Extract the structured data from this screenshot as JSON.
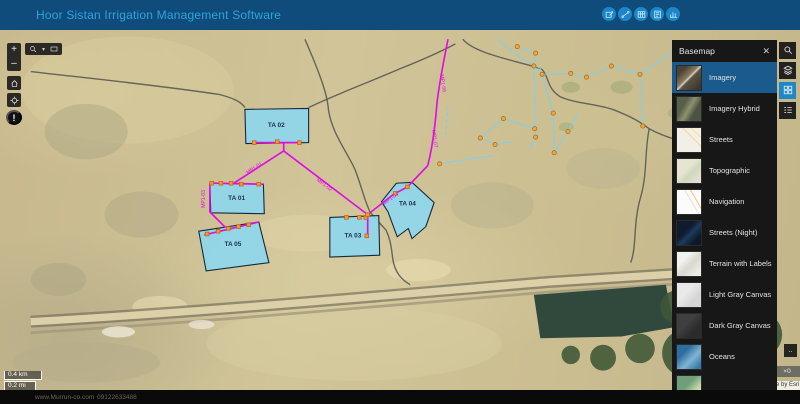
{
  "header": {
    "title": "Hoor Sistan Irrigation Management Software",
    "tools": [
      {
        "name": "edit-tool"
      },
      {
        "name": "measure-tool"
      },
      {
        "name": "table-tool"
      },
      {
        "name": "report-tool"
      },
      {
        "name": "chart-tool"
      }
    ]
  },
  "left_toolbar": {
    "zoom_in": "+",
    "zoom_out": "–",
    "track_glyph": "!"
  },
  "scalebar": {
    "km": "0.4 km",
    "mi": "0.2 mi"
  },
  "basemap_panel": {
    "title": "Basemap",
    "close_glyph": "✕",
    "items": [
      {
        "label": "Imagery",
        "thumb": "imagery",
        "selected": true
      },
      {
        "label": "Imagery Hybrid",
        "thumb": "hybrid",
        "selected": false
      },
      {
        "label": "Streets",
        "thumb": "streets",
        "selected": false
      },
      {
        "label": "Topographic",
        "thumb": "topo",
        "selected": false
      },
      {
        "label": "Navigation",
        "thumb": "nav",
        "selected": false
      },
      {
        "label": "Streets (Night)",
        "thumb": "night",
        "selected": false
      },
      {
        "label": "Terrain with Labels",
        "thumb": "terrain",
        "selected": false
      },
      {
        "label": "Light Gray Canvas",
        "thumb": "lightgray",
        "selected": false
      },
      {
        "label": "Dark Gray Canvas",
        "thumb": "darkgray",
        "selected": false
      },
      {
        "label": "Oceans",
        "thumb": "oceans",
        "selected": false
      },
      {
        "label": "",
        "thumb": "natgeo",
        "selected": false
      }
    ]
  },
  "attribution": {
    "partial": "e by Esri",
    "badge": "×0",
    "expand_glyph": ".."
  },
  "footer": {
    "website": "www.Murrun-co.com",
    "phone": "09122633488"
  },
  "map_features": {
    "colors": {
      "pipe": "#e10ee1",
      "channel": "#7dcff0",
      "zone_fill": "#8ed7ec",
      "zone_stroke": "#16293c",
      "marker": "#f49b2d",
      "marker_stroke": "#c45f12",
      "boundary": "#52524c",
      "node": "#f2a43e",
      "node_stroke": "#a86a1a",
      "zone_label": "#1d2f52"
    },
    "zones": [
      {
        "label": "TA 02",
        "points": "232,116 301,115 301,152 233,153",
        "lx": 266,
        "ly": 135
      },
      {
        "label": "TA 01",
        "points": "194,196 252,197 253,229 195,228",
        "lx": 223,
        "ly": 214
      },
      {
        "label": "TA 05",
        "points": "182,248 247,238 258,282 190,291",
        "lx": 219,
        "ly": 264
      },
      {
        "label": "TA 03",
        "points": "324,233 377,231 378,274 324,276",
        "lx": 349,
        "ly": 255
      },
      {
        "label": "TA 04",
        "points": "380,216 396,196 413,195 437,217 428,243 413,256 409,245 397,254 387,227",
        "lx": 408,
        "ly": 220
      }
    ],
    "pipes": [
      "M452,40 C447,65 442,90 440,110 C438,135 435,158 430,177",
      "M430,177 L408,200 L393,208 L365,230",
      "M365,230 L274,161",
      "M274,161 L274,152 M242,152 L292,152",
      "M274,161 L220,196",
      "M196,196 L252,197",
      "M194,197 L194,227 L211,244",
      "M188,252 L247,238",
      "M365,230 L365,254"
    ],
    "pipe_labels": [
      {
        "t": "MP1-01",
        "x": 243,
        "y": 181,
        "r": -33
      },
      {
        "t": "MP1-02",
        "x": 317,
        "y": 199,
        "r": 37
      },
      {
        "t": "MP1-04",
        "x": 391,
        "y": 214,
        "r": -36
      },
      {
        "t": "MP1-03",
        "x": 189,
        "y": 213,
        "r": -90
      },
      {
        "t": "MP1-06",
        "x": 445,
        "y": 88,
        "r": 82
      },
      {
        "t": "MP1-07",
        "x": 436,
        "y": 148,
        "r": 82
      }
    ],
    "markers": [
      [
        242,
        152
      ],
      [
        267,
        151
      ],
      [
        291,
        152
      ],
      [
        196,
        196
      ],
      [
        206,
        196
      ],
      [
        217,
        196
      ],
      [
        228,
        197
      ],
      [
        247,
        197
      ],
      [
        191,
        251
      ],
      [
        203,
        248
      ],
      [
        214,
        245
      ],
      [
        225,
        243
      ],
      [
        236,
        241
      ],
      [
        342,
        233
      ],
      [
        356,
        233
      ],
      [
        363,
        233
      ],
      [
        364,
        253
      ],
      [
        408,
        200
      ],
      [
        395,
        207
      ],
      [
        365,
        230
      ]
    ],
    "channels": [
      "527,48 547,55 545,69 554,78 585,77 602,81 629,69 660,78 663,134",
      "545,69 546,105 546,137 547,146 540,160",
      "554,78 566,120 567,163",
      "512,126 546,137",
      "512,126 487,147 503,154 522,151",
      "567,163 582,140 592,122",
      "505,40 530,60 553,72",
      "660,78 706,47",
      "706,47 764,66 800,82",
      "443,175 475,170 500,166"
    ],
    "channel_nodes": [
      [
        527,
        48
      ],
      [
        547,
        55
      ],
      [
        545,
        69
      ],
      [
        554,
        78
      ],
      [
        585,
        77
      ],
      [
        602,
        81
      ],
      [
        629,
        69
      ],
      [
        660,
        78
      ],
      [
        566,
        120
      ],
      [
        512,
        126
      ],
      [
        546,
        137
      ],
      [
        487,
        147
      ],
      [
        503,
        154
      ],
      [
        547,
        146
      ],
      [
        567,
        163
      ],
      [
        582,
        140
      ],
      [
        663,
        134
      ],
      [
        706,
        47
      ],
      [
        764,
        66
      ],
      [
        443,
        175
      ]
    ],
    "dashed_channel": "M452,112 L449,148",
    "boundaries": [
      "M297,40 C310,70 320,95 322,112 C324,140 345,165 352,183 C360,205 362,216 368,228 L385,247 C390,258 391,268 392,277 C394,292 401,300 411,306",
      "M468,40 C480,55 520,62 553,72 C562,80 558,92 573,102 C590,110 615,110 633,117 C650,124 658,128 670,137 C690,148 710,152 735,156 C760,161 782,168 800,174",
      "M0,75 C60,82 140,90 205,100 C220,104 228,108 232,114",
      "M301,114 C330,100 370,85 400,72 C425,62 445,53 460,45",
      "M670,137 C665,160 668,185 661,210 C652,240 657,262 650,282"
    ]
  }
}
